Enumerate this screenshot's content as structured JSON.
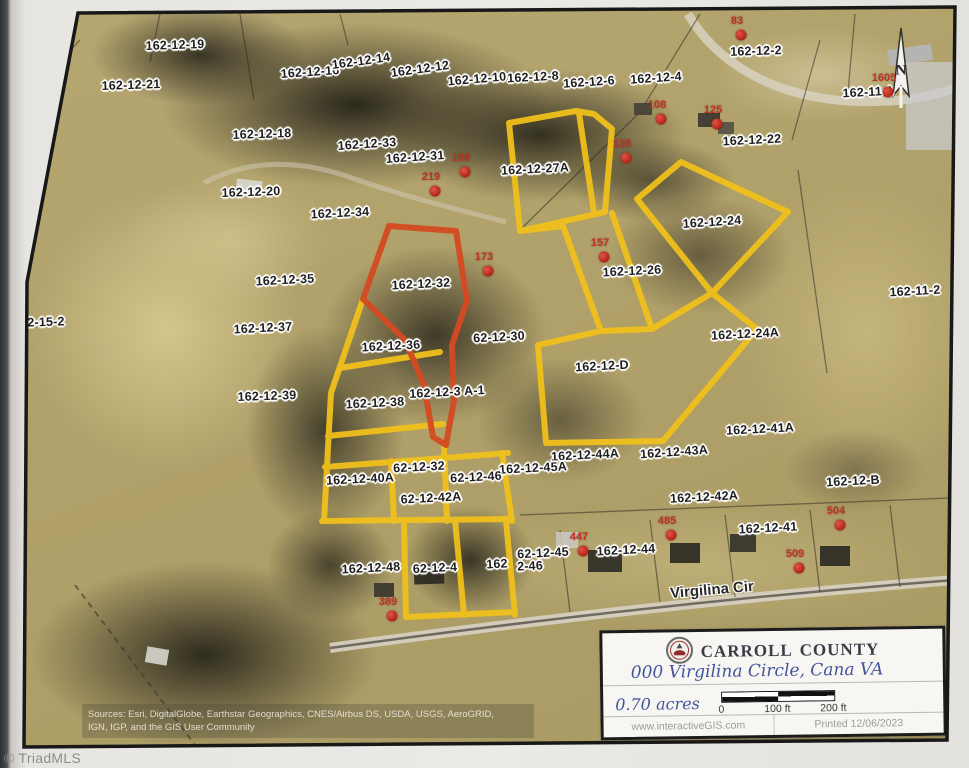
{
  "paper": {
    "watermark": "© TriadMLS"
  },
  "map": {
    "street_label": "Virgilina Cir",
    "north_label": "N",
    "edge_label_right": "16",
    "attribution_line1": "Sources: Esri, DigitalGlobe, Earthstar Geographics, CNES/Airbus DS, USDA, USGS, AeroGRID,",
    "attribution_line2": "IGN, IGP, and the GIS User Community",
    "highlight_colors": {
      "selected_parcels": "#f0c01c",
      "subject_parcel": "#d44a22",
      "house_numbers": "#c23322"
    },
    "parcels": [
      {
        "label": "162-12-19",
        "x": 175,
        "y": 45,
        "r": -2
      },
      {
        "label": "162-12-21",
        "x": 131,
        "y": 85,
        "r": -2
      },
      {
        "label": "162-12-16",
        "x": 310,
        "y": 72,
        "r": -4
      },
      {
        "label": "162-12-14",
        "x": 361,
        "y": 61,
        "r": -8
      },
      {
        "label": "162-12-12",
        "x": 420,
        "y": 69,
        "r": -8
      },
      {
        "label": "162-12-10",
        "x": 477,
        "y": 79,
        "r": -5
      },
      {
        "label": "162-12-8",
        "x": 533,
        "y": 77,
        "r": -3
      },
      {
        "label": "162-12-6",
        "x": 589,
        "y": 82,
        "r": -4
      },
      {
        "label": "162-12-4",
        "x": 656,
        "y": 78,
        "r": -4
      },
      {
        "label": "162-12-2",
        "x": 756,
        "y": 51,
        "r": -2
      },
      {
        "label": "162-11-1",
        "x": 868,
        "y": 92,
        "r": -3
      },
      {
        "label": "162-12-22",
        "x": 752,
        "y": 140,
        "r": -3
      },
      {
        "label": "162-12-18",
        "x": 262,
        "y": 134,
        "r": -2
      },
      {
        "label": "162-12-33",
        "x": 367,
        "y": 144,
        "r": -4
      },
      {
        "label": "162-12-31",
        "x": 415,
        "y": 157,
        "r": -4
      },
      {
        "label": "162-12-27A",
        "x": 535,
        "y": 169,
        "r": -3
      },
      {
        "label": "162-12-20",
        "x": 251,
        "y": 192,
        "r": -2
      },
      {
        "label": "162-12-34",
        "x": 340,
        "y": 213,
        "r": -3
      },
      {
        "label": "162-12-24",
        "x": 712,
        "y": 222,
        "r": -4
      },
      {
        "label": "162-12-26",
        "x": 632,
        "y": 271,
        "r": -3
      },
      {
        "label": "162-12-35",
        "x": 285,
        "y": 280,
        "r": -3
      },
      {
        "label": "162-12-32",
        "x": 421,
        "y": 284,
        "r": -3
      },
      {
        "label": "162-11-2",
        "x": 915,
        "y": 291,
        "r": -3
      },
      {
        "label": "2-15-2",
        "x": 46,
        "y": 322,
        "r": -2
      },
      {
        "label": "162-12-37",
        "x": 263,
        "y": 328,
        "r": -3
      },
      {
        "label": "62-12-30",
        "x": 499,
        "y": 337,
        "r": -3
      },
      {
        "label": "162-12-24A",
        "x": 745,
        "y": 334,
        "r": -3
      },
      {
        "label": "162-12-36",
        "x": 391,
        "y": 346,
        "r": -3
      },
      {
        "label": "162-12-D",
        "x": 602,
        "y": 366,
        "r": -3
      },
      {
        "label": "162-12-39",
        "x": 267,
        "y": 396,
        "r": -2
      },
      {
        "label": "162-12-3 A-1",
        "x": 447,
        "y": 392,
        "r": -3
      },
      {
        "label": "162-12-38",
        "x": 375,
        "y": 403,
        "r": -3
      },
      {
        "label": "162-12-41A",
        "x": 760,
        "y": 429,
        "r": -3
      },
      {
        "label": "162-12-44A",
        "x": 585,
        "y": 455,
        "r": -3
      },
      {
        "label": "162-12-43A",
        "x": 674,
        "y": 452,
        "r": -4
      },
      {
        "label": "62-12-32",
        "x": 419,
        "y": 467,
        "r": -3
      },
      {
        "label": "162-12-45A",
        "x": 533,
        "y": 468,
        "r": -3
      },
      {
        "label": "62-12-46",
        "x": 476,
        "y": 477,
        "r": -3
      },
      {
        "label": "162-12-40A",
        "x": 360,
        "y": 479,
        "r": -3
      },
      {
        "label": "162-12-42A",
        "x": 704,
        "y": 497,
        "r": -3
      },
      {
        "label": "62-12-42A",
        "x": 431,
        "y": 498,
        "r": -3
      },
      {
        "label": "162-12-B",
        "x": 853,
        "y": 481,
        "r": -3
      },
      {
        "label": "162-12-41",
        "x": 768,
        "y": 528,
        "r": -3
      },
      {
        "label": "162-12-44",
        "x": 626,
        "y": 550,
        "r": -3
      },
      {
        "label": "62-12-45",
        "x": 543,
        "y": 553,
        "r": -3
      },
      {
        "label": "162",
        "x": 497,
        "y": 564,
        "r": -3
      },
      {
        "label": "2-46",
        "x": 530,
        "y": 566,
        "r": -3
      },
      {
        "label": "62-12-4",
        "x": 435,
        "y": 568,
        "r": -3
      },
      {
        "label": "162-12-48",
        "x": 371,
        "y": 568,
        "r": -3
      },
      {
        "label": "16",
        "x": 958,
        "y": 599,
        "r": 0
      }
    ],
    "house_numbers": [
      {
        "label": "83",
        "x": 737,
        "y": 21
      },
      {
        "label": "1605",
        "x": 884,
        "y": 78
      },
      {
        "label": "125",
        "x": 713,
        "y": 110
      },
      {
        "label": "108",
        "x": 657,
        "y": 105
      },
      {
        "label": "135",
        "x": 622,
        "y": 144
      },
      {
        "label": "108",
        "x": 461,
        "y": 158
      },
      {
        "label": "219",
        "x": 431,
        "y": 177
      },
      {
        "label": "157",
        "x": 600,
        "y": 243
      },
      {
        "label": "173",
        "x": 484,
        "y": 257
      },
      {
        "label": "485",
        "x": 667,
        "y": 521
      },
      {
        "label": "447",
        "x": 579,
        "y": 537
      },
      {
        "label": "504",
        "x": 836,
        "y": 511
      },
      {
        "label": "509",
        "x": 795,
        "y": 554
      },
      {
        "label": "389",
        "x": 388,
        "y": 602
      }
    ]
  },
  "title_block": {
    "county": "Carroll County",
    "address": "000 Virgilina Circle, Cana VA",
    "acres": "0.70 acres",
    "scale": {
      "start": "0",
      "mid": "100 ft",
      "end": "200 ft"
    },
    "website": "www.interactiveGIS.com",
    "printed": "Printed 12/06/2023"
  }
}
